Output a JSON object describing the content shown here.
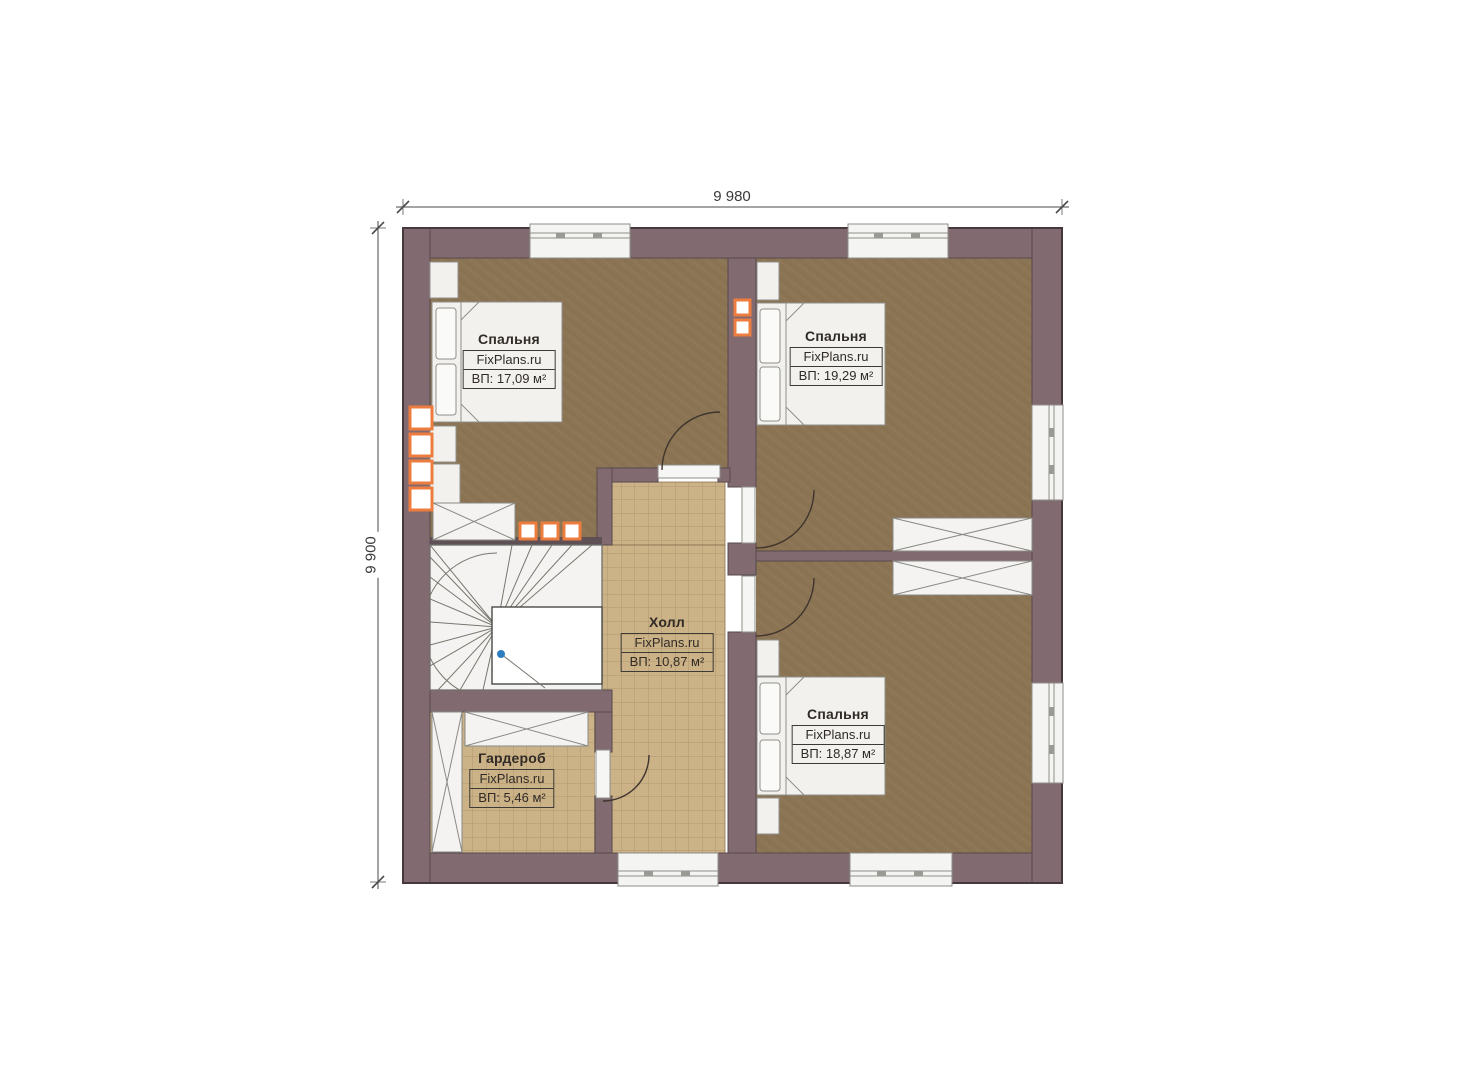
{
  "page": {
    "background": "#ffffff"
  },
  "plan": {
    "type": "floor-plan",
    "dimensions": {
      "width": "9 980",
      "height": "9 900"
    },
    "colors": {
      "wall": "#816B70",
      "carpet_floor": "#8B7453",
      "tile_floor": "#CCB287",
      "accent_orange": "#ED7D3F",
      "furniture": "#F2F1EE"
    },
    "rooms": [
      {
        "id": "bedroom-top-left",
        "name": "Спальня",
        "brand": "FixPlans.ru",
        "area": "ВП: 17,09 м²"
      },
      {
        "id": "bedroom-top-right",
        "name": "Спальня",
        "brand": "FixPlans.ru",
        "area": "ВП: 19,29 м²"
      },
      {
        "id": "bedroom-bottom-right",
        "name": "Спальня",
        "brand": "FixPlans.ru",
        "area": "ВП: 18,87 м²"
      },
      {
        "id": "hall",
        "name": "Холл",
        "brand": "FixPlans.ru",
        "area": "ВП: 10,87 м²"
      },
      {
        "id": "wardrobe",
        "name": "Гардероб",
        "brand": "FixPlans.ru",
        "area": "ВП: 5,46 м²"
      }
    ]
  }
}
